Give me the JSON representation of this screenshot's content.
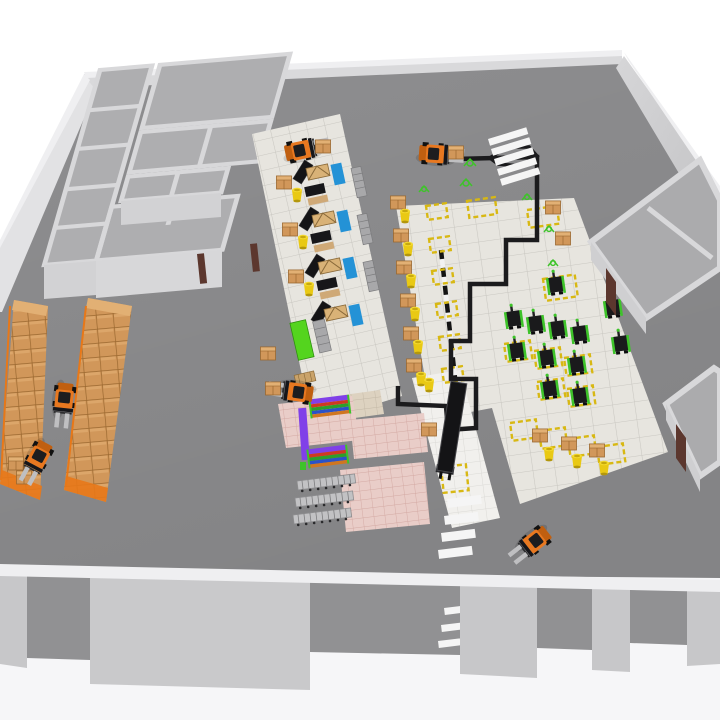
{
  "scene": {
    "description": "3D rendered warehouse interior: grey floor with perimeter walls, office room cluster top-left, two pallet-rack rows of stacked cardboard boxes with forklifts on the left, tiled workstation zone in the center, AGV robot staging zone with yellow dashed floor markings and black guide path on the right, pink shelving zone with colored racks, conveyor belt, pedestrian crosswalks, and a front wall with loading openings",
    "zones": [
      "office-rooms",
      "pallet-racking",
      "workstation-zone",
      "agv-zone",
      "barrel-staging-strip",
      "pink-shelving-zone",
      "conveyor-strip",
      "side-rooms"
    ],
    "counts": {
      "forklifts": 6,
      "agv_robots": 12,
      "pallet_rack_rows": 2,
      "workstation_rows": 4,
      "yellow_barrels": 13,
      "cardboard_boxes": 21,
      "office_rooms": 9,
      "side_rooms": 2,
      "conveyors": 1,
      "crosswalks": 2,
      "yellow_dashed_markings": 19,
      "multicolor_shelf_racks": 2,
      "cart_rows": 3,
      "green_ghost_markers": 6
    }
  },
  "colors": {
    "bg": "#ffffff",
    "exterior": "#f6f6f8",
    "floor": "#8e8e90",
    "roomFloor": "#aeaeb0",
    "wallFace": "#c7c7c9",
    "wallLight": "#d8d8da",
    "wallTop": "#efeff1",
    "tile": "#e7e5df",
    "tileLine": "#c9c7c1",
    "pink": "#e9cdc8",
    "pinkLine": "#d3a9a3",
    "whiteTile": "#f1f0ed",
    "whiteTileLine": "#dbdad6",
    "beige": "#ddd2c0",
    "beigeLine": "#c3b8a6",
    "forklift": "#e87820",
    "forkliftDark": "#c05f10",
    "mast": "#16161a",
    "boxTan": "#d1975a",
    "boxLine": "#9a6830",
    "boxTop": "#e2b074",
    "barrel": "#e9c914",
    "robotBody": "#1a1a1c",
    "robotGreen": "#3ec32a",
    "path": "#1b1b1d",
    "marking": "#d8b813",
    "blue": "#2492d6",
    "greenLocker": "#54d41e",
    "purple": "#8040e8",
    "shelfRed": "#cf3a20",
    "shelfGreen": "#2f9e2a",
    "shelfBlue": "#2b52c8",
    "shelfOrange": "#d07620",
    "conveyor": "#141416",
    "door": "#5c372e",
    "crosswalk": "#f5f5f5",
    "rackOrange": "#e87818",
    "cart": "#c2c2c4"
  }
}
